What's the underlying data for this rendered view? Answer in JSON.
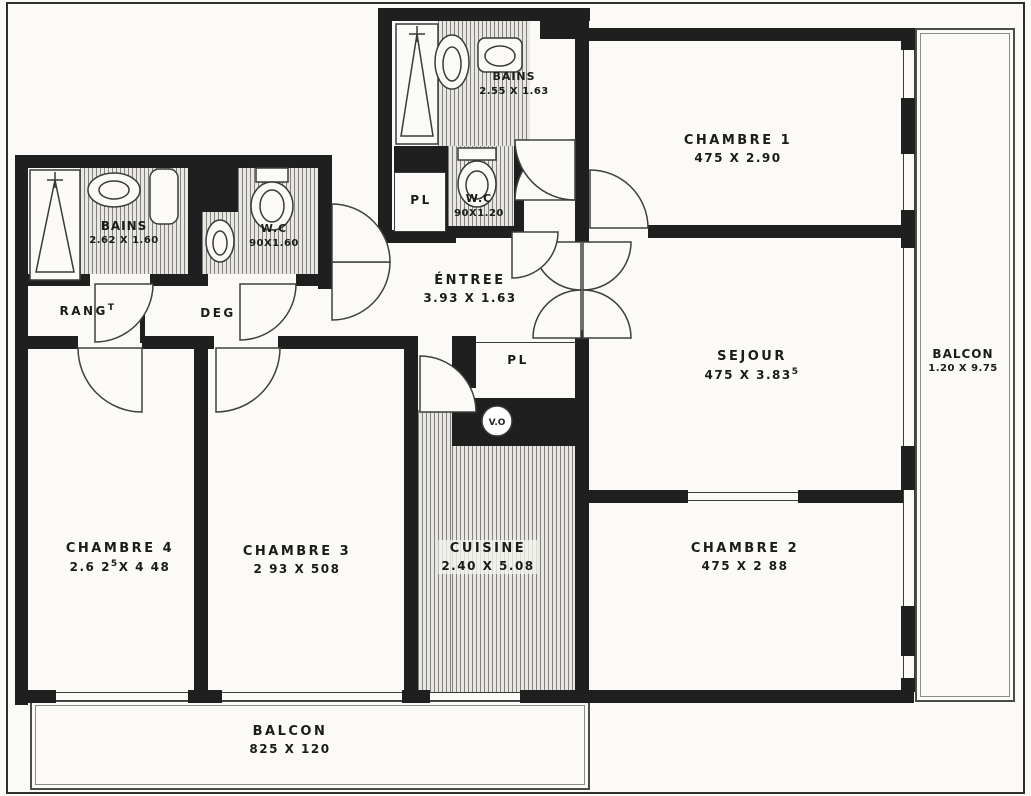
{
  "plan": {
    "rooms": {
      "chambre1": {
        "name": "CHAMBRE 1",
        "dims": "475 X 2.90"
      },
      "sejour": {
        "name": "SEJOUR",
        "dims": "475 X 3.83",
        "sup": "5"
      },
      "chambre2": {
        "name": "CHAMBRE 2",
        "dims": "475 X 2 88"
      },
      "chambre3": {
        "name": "CHAMBRE 3",
        "dims": "2 93 X 508"
      },
      "chambre4": {
        "name": "CHAMBRE 4",
        "dims_pre": "2.6 2",
        "sup": "5",
        "dims_post": "X 4 48"
      },
      "entree": {
        "name": "ÉNTREE",
        "dims": "3.93 X 1.63"
      },
      "cuisine": {
        "name": "CUISINE",
        "dims": "2.40 X 5.08"
      },
      "bains_top": {
        "name": "BAINS",
        "dims": "2.55 X 1.63"
      },
      "wc_top": {
        "name": "W.C",
        "dims": "90X1.20"
      },
      "bains_left": {
        "name": "BAINS",
        "dims": "2.62 X 1.60"
      },
      "wc_left": {
        "name": "W.C",
        "dims": "90X1.60"
      },
      "rang": {
        "name": "RANG",
        "sup": "T"
      },
      "deg": {
        "name": "DEG"
      },
      "pl_hall": {
        "name": "PL"
      },
      "pl_entree": {
        "name": "PL"
      },
      "vide_ordures": {
        "name": "V.O"
      },
      "balcon_right": {
        "name": "BALCON",
        "dims": "1.20 X 9.75"
      },
      "balcon_bottom": {
        "name": "BALCON",
        "dims": "825 X 120"
      }
    },
    "colors": {
      "wall": "#1f1f1f",
      "line": "#4b4b4b",
      "paper": "#fbfaf6",
      "hatch_bg": "#e9e7e1"
    }
  }
}
